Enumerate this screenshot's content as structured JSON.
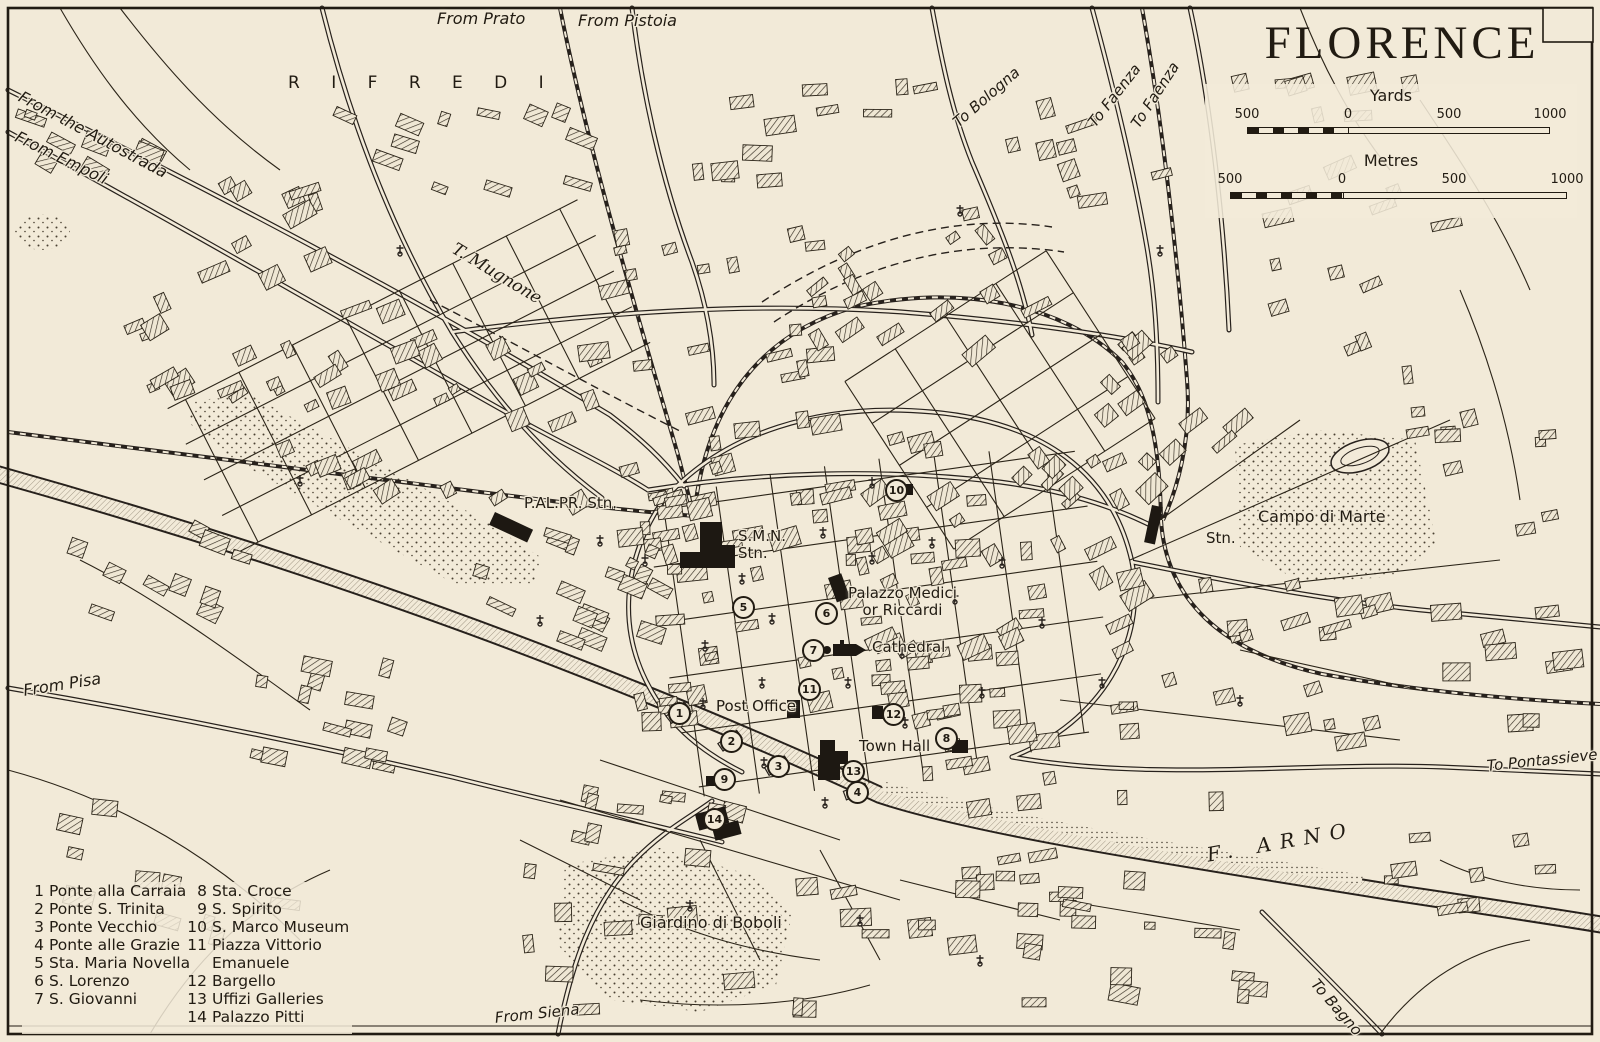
{
  "map_title": "FLORENCE",
  "scale_panel": {
    "yards": {
      "label": "Yards",
      "ticks": [
        "500",
        "0",
        "500",
        "1000"
      ]
    },
    "metres": {
      "label": "Metres",
      "ticks": [
        "500",
        "0",
        "500",
        "1000"
      ]
    }
  },
  "legend": {
    "columns": [
      {
        "items": [
          {
            "num": "1",
            "name": "Ponte alla Carraia"
          },
          {
            "num": "2",
            "name": "Ponte S. Trinita"
          },
          {
            "num": "3",
            "name": "Ponte Vecchio"
          },
          {
            "num": "4",
            "name": "Ponte alle Grazie"
          },
          {
            "num": "5",
            "name": "Sta. Maria Novella"
          },
          {
            "num": "6",
            "name": "S. Lorenzo"
          },
          {
            "num": "7",
            "name": "S. Giovanni"
          }
        ]
      },
      {
        "items": [
          {
            "num": "8",
            "name": "Sta. Croce"
          },
          {
            "num": "9",
            "name": "S. Spirito"
          },
          {
            "num": "10",
            "name": "S. Marco Museum"
          },
          {
            "num": "11",
            "name": "Piazza Vittorio",
            "name2": "Emanuele"
          },
          {
            "num": "12",
            "name": "Bargello"
          },
          {
            "num": "13",
            "name": "Uffizi Galleries"
          },
          {
            "num": "14",
            "name": "Palazzo Pitti"
          }
        ]
      }
    ]
  },
  "labels": [
    {
      "text": "From Prato",
      "x": 437,
      "y": 10
    },
    {
      "text": "From Pistoia",
      "x": 578,
      "y": 12
    },
    {
      "text": "To Bologna",
      "x": 950,
      "y": 118
    },
    {
      "text": "To Faenza",
      "x": 1085,
      "y": 120
    },
    {
      "text": "To Faenza",
      "x": 1128,
      "y": 122
    },
    {
      "text": "R I F R E D I",
      "x": 288,
      "y": 74
    },
    {
      "text": "From the Autostrada",
      "x": 24,
      "y": 88
    },
    {
      "text": "From Empoli",
      "x": 20,
      "y": 128
    },
    {
      "text": "T. Mugnone",
      "x": 458,
      "y": 240
    },
    {
      "text": "From Pisa",
      "x": 22,
      "y": 682
    },
    {
      "text": "P.AL.PR. Stn.",
      "x": 524,
      "y": 495
    },
    {
      "text": "S.M.N.\nStn.",
      "x": 738,
      "y": 528
    },
    {
      "text": "Palazzo Medici\nor Riccardi",
      "x": 848,
      "y": 585
    },
    {
      "text": "Cathedral",
      "x": 872,
      "y": 639
    },
    {
      "text": "Post Office",
      "x": 716,
      "y": 698
    },
    {
      "text": "Town Hall",
      "x": 859,
      "y": 738
    },
    {
      "text": "Campo di Marte",
      "x": 1258,
      "y": 508
    },
    {
      "text": "Stn.",
      "x": 1206,
      "y": 530
    },
    {
      "text": "F. ARNO",
      "x": 1205,
      "y": 844
    },
    {
      "text": "To Pontassieve",
      "x": 1486,
      "y": 758
    },
    {
      "text": "Giardino di Boboli",
      "x": 640,
      "y": 914
    },
    {
      "text": "From Siena",
      "x": 494,
      "y": 1010
    },
    {
      "text": "To Bagno",
      "x": 1320,
      "y": 976
    }
  ],
  "markers": [
    {
      "n": "1",
      "x": 678,
      "y": 712
    },
    {
      "n": "2",
      "x": 730,
      "y": 740
    },
    {
      "n": "3",
      "x": 777,
      "y": 765
    },
    {
      "n": "4",
      "x": 856,
      "y": 791
    },
    {
      "n": "5",
      "x": 742,
      "y": 606
    },
    {
      "n": "6",
      "x": 825,
      "y": 612
    },
    {
      "n": "7",
      "x": 812,
      "y": 649
    },
    {
      "n": "8",
      "x": 945,
      "y": 737
    },
    {
      "n": "9",
      "x": 723,
      "y": 778
    },
    {
      "n": "10",
      "x": 895,
      "y": 489
    },
    {
      "n": "11",
      "x": 808,
      "y": 688
    },
    {
      "n": "12",
      "x": 892,
      "y": 713
    },
    {
      "n": "13",
      "x": 852,
      "y": 770
    },
    {
      "n": "14",
      "x": 713,
      "y": 818
    }
  ]
}
